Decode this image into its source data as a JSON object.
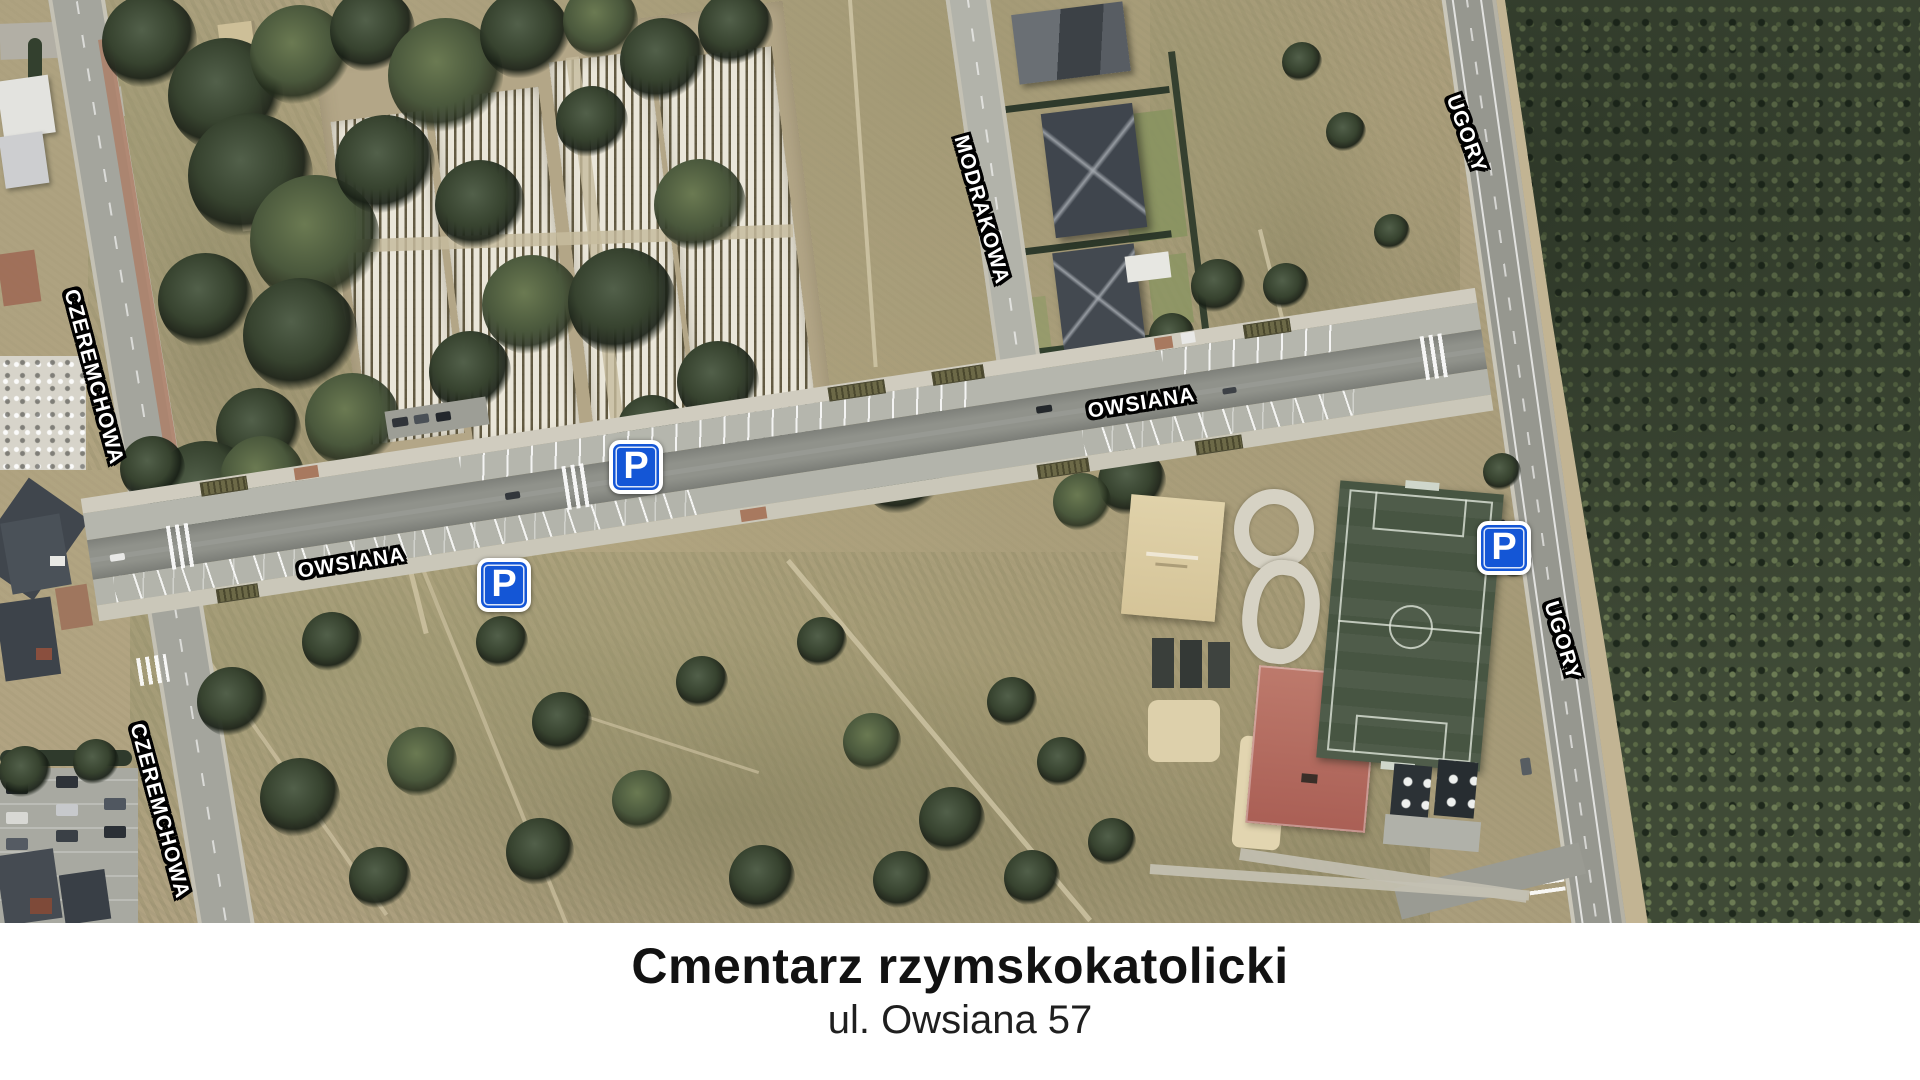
{
  "map": {
    "description": "aerial-satellite-map",
    "street_labels": [
      {
        "id": "czeremchowa-upper",
        "text": "CZEREMCHOWA"
      },
      {
        "id": "czeremchowa-lower",
        "text": "CZEREMCHOWA"
      },
      {
        "id": "modrakowa",
        "text": "MODRAKOWA"
      },
      {
        "id": "owsiana-west",
        "text": "OWSIANA"
      },
      {
        "id": "owsiana-east",
        "text": "OWSIANA"
      },
      {
        "id": "ugory-north",
        "text": "UGORY"
      },
      {
        "id": "ugory-south",
        "text": "UGORY"
      }
    ],
    "parking_signs": [
      {
        "glyph": "P"
      },
      {
        "glyph": "P"
      },
      {
        "glyph": "P"
      }
    ],
    "colors": {
      "parking_sign_blue": "#1456d6",
      "label_fill": "#ffffff",
      "label_outline": "#000000"
    }
  },
  "caption": {
    "title": "Cmentarz rzymskokatolicki",
    "subtitle": "ul. Owsiana 57"
  }
}
